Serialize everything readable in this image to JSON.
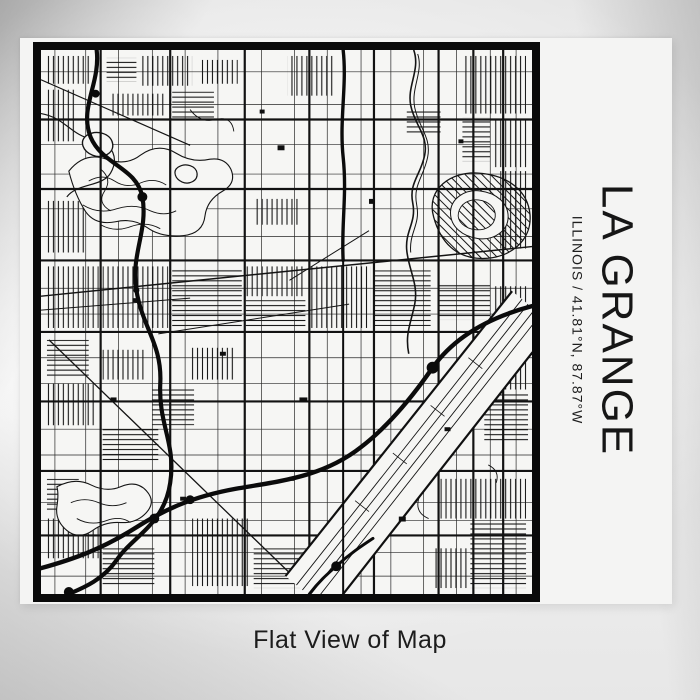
{
  "poster": {
    "title": "LA GRANGE",
    "subtitle": "ILLINOIS / 41.81°N, 87.87°W",
    "map_style": "black and white street line map",
    "colors": {
      "ink": "#141414",
      "frame": "#0a0a0a",
      "paper": "#f4f4f3",
      "map_background": "#f6f6f4",
      "wall_background": "#efefef"
    }
  },
  "caption": "Flat View of Map"
}
